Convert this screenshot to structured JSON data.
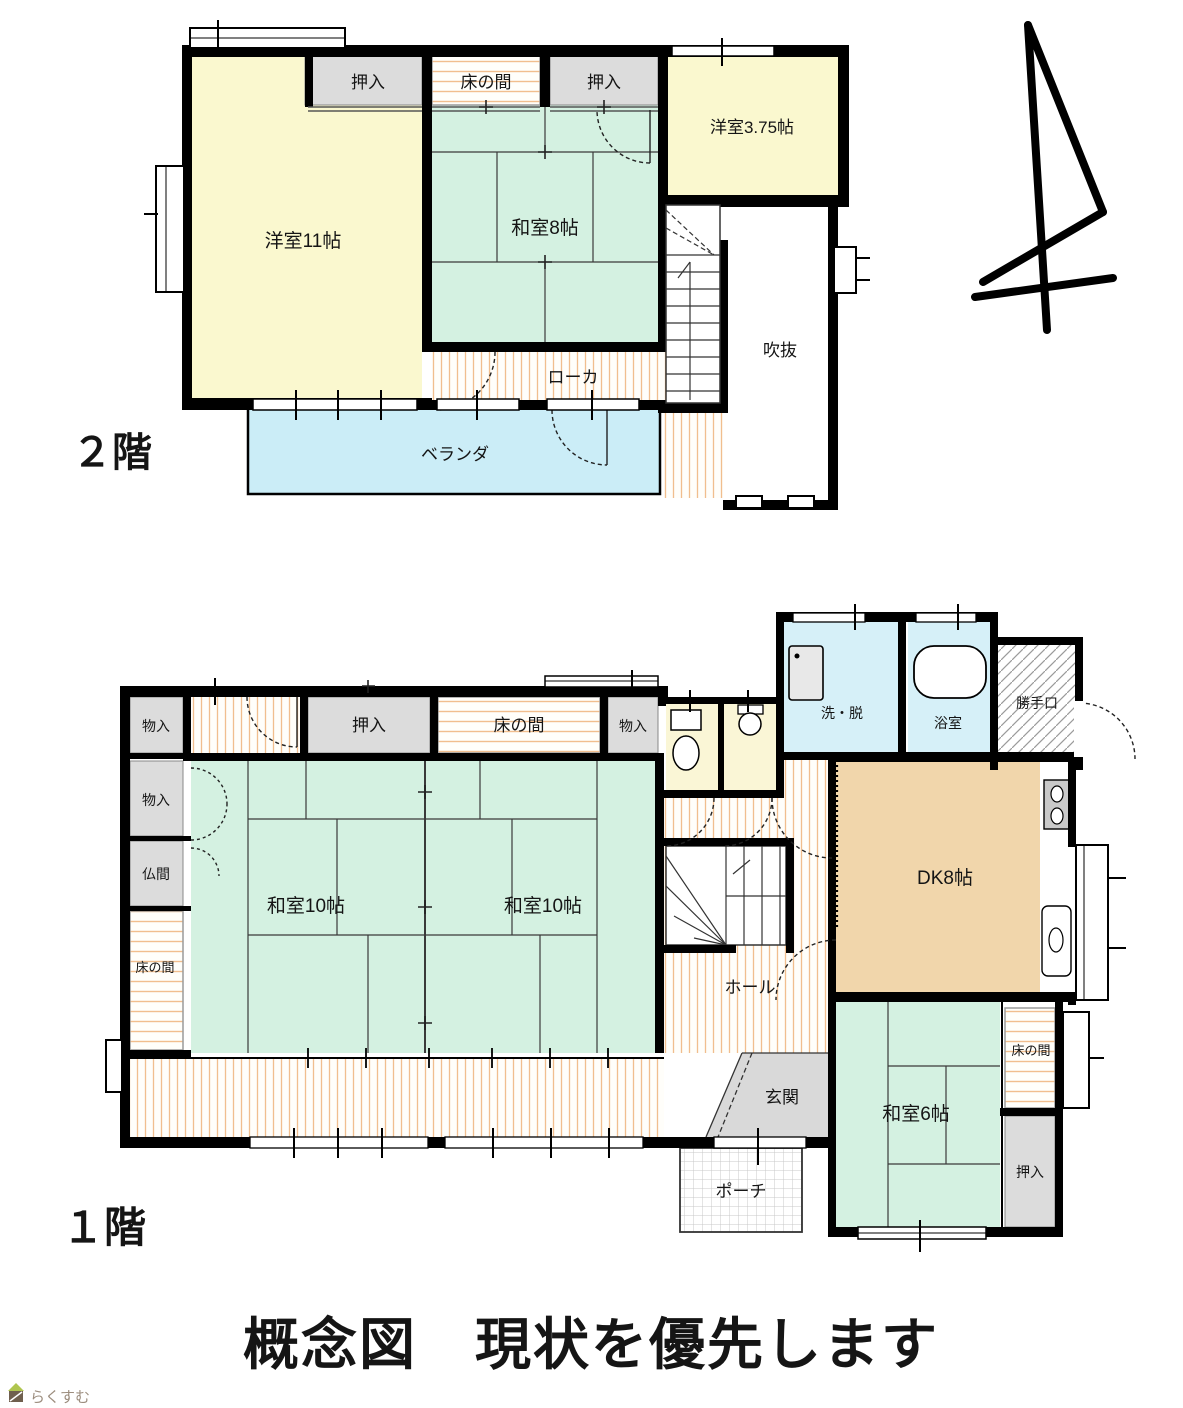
{
  "page": {
    "title": "概念図　現状を優先します",
    "watermark": "らくすむ"
  },
  "floor2": {
    "label": "２階",
    "rooms": {
      "oshiire_left": "押入",
      "tokonoma": "床の間",
      "oshiire_right": "押入",
      "yoshitsu_375": "洋室3.75帖",
      "yoshitsu_11": "洋室11帖",
      "washitsu_8": "和室8帖",
      "roka": "ローカ",
      "fukinuke": "吹抜",
      "veranda": "ベランダ"
    }
  },
  "floor1": {
    "label": "１階",
    "rooms": {
      "monoire_top": "物入",
      "oshiire_top": "押入",
      "tokonoma_top": "床の間",
      "monoire_top2": "物入",
      "monoire_left": "物入",
      "butsuma": "仏間",
      "tokonoma_left": "床の間",
      "washitsu10_left": "和室10帖",
      "washitsu10_right": "和室10帖",
      "sentaku": "洗・脱",
      "yokushitsu": "浴室",
      "katteguchi": "勝手口",
      "dk": "DK8帖",
      "hall": "ホール",
      "genkan": "玄関",
      "porch": "ポーチ",
      "washitsu6": "和室6帖",
      "tokonoma_right": "床の間",
      "oshiire_bottom": "押入"
    }
  },
  "colors": {
    "wall": "#000000",
    "yellow_room": "#FAF8CF",
    "tatami_green": "#D4F1E1",
    "water_blue": "#D6F0F8",
    "veranda_blue": "#CBEDF7",
    "dk_tan": "#F1D6AB",
    "closet_gray": "#DCDCDC",
    "genkan_gray": "#D9D9D9",
    "toilet_cream": "#FAF6D6",
    "stripe_orange": "#F1BE8E",
    "watermark_text": "#9C8D7E",
    "watermark_roof": "#AFC54F",
    "watermark_body": "#6F5F4E"
  }
}
